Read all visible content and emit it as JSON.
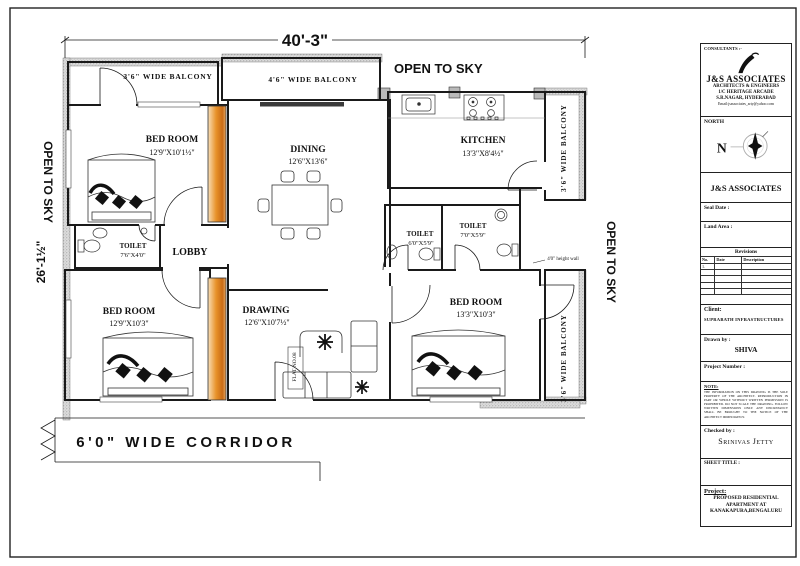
{
  "plan": {
    "dim_top": "40'-3\"",
    "dim_left": "26'-1½\"",
    "open_sky_top": "OPEN TO SKY",
    "open_sky_left": "OPEN TO SKY",
    "open_sky_right": "OPEN TO SKY",
    "corridor_label": "6'0\" WIDE CORRIDOR",
    "flat_label": "FLAT NO.08",
    "wall_note": "4'0\" height wall",
    "balcony_top_left": "3'6\" WIDE BALCONY",
    "balcony_top_mid": "4'6\" WIDE BALCONY",
    "balcony_right_top": "3'6\" WIDE BALCONY",
    "balcony_right_bottom": "3'6\" WIDE BALCONY",
    "bedroom1": {
      "name": "BED ROOM",
      "dim": "12'9\"X10'1½\""
    },
    "dining": {
      "name": "DINING",
      "dim": "12'6\"X13'6\""
    },
    "kitchen": {
      "name": "KITCHEN",
      "dim": "13'3\"X8'4½\""
    },
    "toilet1": {
      "name": "TOILET",
      "dim": "7'6\"X4'0\""
    },
    "lobby": {
      "name": "LOBBY"
    },
    "toilet2": {
      "name": "TOILET",
      "dim": "6'0\"X5'9\""
    },
    "toilet3": {
      "name": "TOILET",
      "dim": "7'0\"X5'9\""
    },
    "bedroom2": {
      "name": "BED ROOM",
      "dim": "12'9\"X10'3\""
    },
    "drawing": {
      "name": "DRAWING",
      "dim": "12'6\"X10'7½\""
    },
    "bedroom3": {
      "name": "BED ROOM",
      "dim": "13'3\"X10'3\""
    }
  },
  "titleblock": {
    "consultants_label": "CONSULTANTS :-",
    "firm_name": "J&S ASSOCIATES",
    "firm_sub1": "ARCHITECTS & ENGINEERS",
    "firm_sub2": "1/C HERITAGE ARCADE",
    "firm_sub3": "S.R.NAGAR, HYDERABAD",
    "firm_email": "Email:jsassociates_arty@yahoo.com",
    "north_label": "NORTH",
    "north_letter": "N",
    "firm_name_2": "J&S ASSOCIATES",
    "seal_date_label": "Seal Date :",
    "land_area_label": "Land Area :",
    "revisions": {
      "title": "Revisions",
      "columns": [
        "No.",
        "Date",
        "Description"
      ],
      "rows": [
        [
          "1.",
          "",
          ""
        ],
        [
          "",
          "",
          ""
        ],
        [
          "",
          "",
          ""
        ],
        [
          "",
          "",
          ""
        ],
        [
          "",
          "",
          ""
        ]
      ]
    },
    "client_label": "Client:",
    "client_name": "SUPRABATH INFRASTRUCTURES",
    "drawn_by_label": "Drawn by :",
    "drawn_by_value": "SHIVA",
    "project_number_label": "Project Number :",
    "note_label": "NOTE:",
    "note_text": "THE INFORMATION ON THIS DRAWING IS THE SOLE PROPERTY OF THE ARCHITECT. REPRODUCTION IN PART OR WHOLE WITHOUT WRITTEN PERMISSION IS PROHIBITED. DO NOT SCALE THE DRAWING. FOLLOW WRITTEN DIMENSIONS ONLY. ANY DISCREPANCY SHALL BE BROUGHT TO THE NOTICE OF THE ARCHITECT IMMEDIATELY.",
    "checked_by_label": "Checked by :",
    "checked_by_value": "Srinivas Jetty",
    "sheet_title_label": "SHEET TITLE :",
    "project_label": "Project:",
    "project_line1": "PROPOSED RESIDENTIAL",
    "project_line2": "APARTMENT AT",
    "project_line3": "KANAKAPURA,BENGALURU"
  },
  "colors": {
    "line": "#1a1a1a",
    "wall_hatch": "#8a8a8a",
    "wardrobe_light": "#f6d9ae",
    "wardrobe_dark": "#c96b15"
  }
}
